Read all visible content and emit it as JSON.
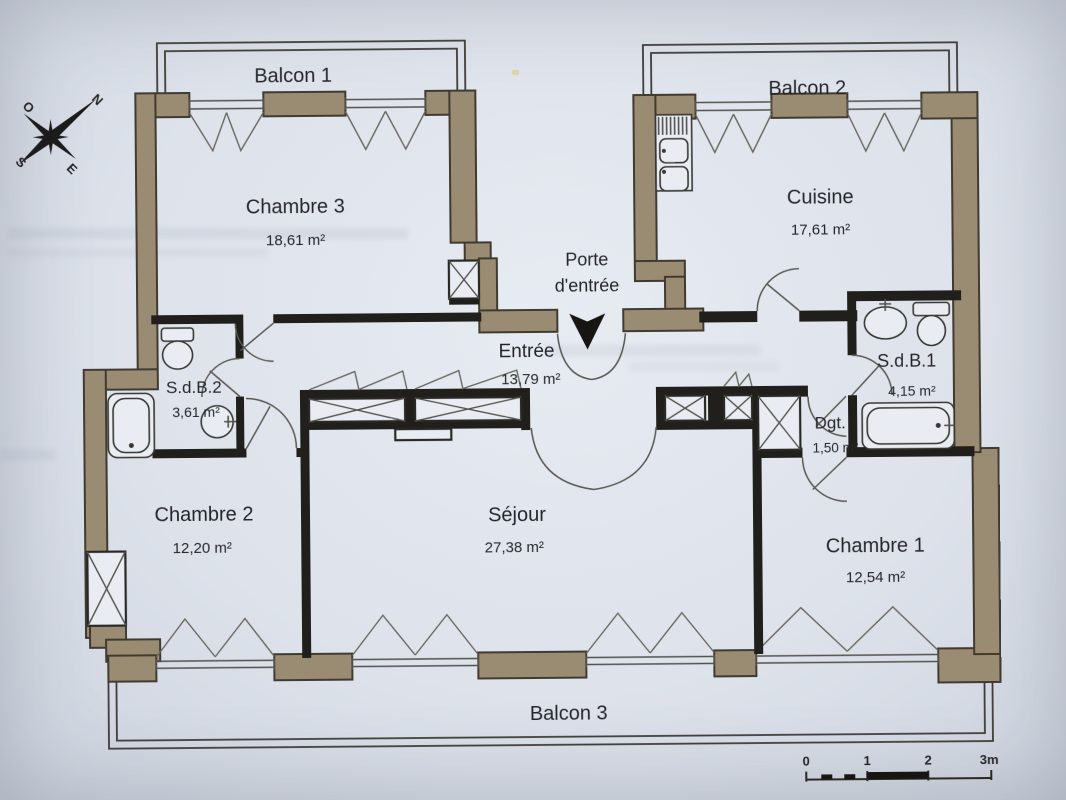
{
  "plan": {
    "balconies": {
      "b1": "Balcon 1",
      "b2": "Balcon 2",
      "b3": "Balcon 3"
    },
    "rooms": {
      "chambre3": {
        "name": "Chambre 3",
        "area": "18,61 m²"
      },
      "cuisine": {
        "name": "Cuisine",
        "area": "17,61 m²"
      },
      "entree": {
        "name": "Entrée",
        "area": "13,79 m²"
      },
      "sdb2": {
        "name": "S.d.B.2",
        "area": "3,61 m²"
      },
      "sdb1": {
        "name": "S.d.B.1",
        "area": "4,15 m²"
      },
      "chambre2": {
        "name": "Chambre 2",
        "area": "12,20 m²"
      },
      "sejour": {
        "name": "Séjour",
        "area": "27,38 m²"
      },
      "chambre1": {
        "name": "Chambre 1",
        "area": "12,54 m²"
      },
      "dgt": {
        "name": "Dgt.",
        "area": "1,50 m²"
      }
    },
    "entrance": {
      "line1": "Porte",
      "line2": "d'entrée"
    },
    "compass": {
      "n": "N",
      "o": "O",
      "s": "S",
      "e": "E"
    },
    "scale": {
      "t0": "0",
      "t1": "1",
      "t2": "2",
      "t3": "3m"
    },
    "colors": {
      "exterior_wall": "#9a8c72",
      "interior_wall": "#211f1b",
      "paper": "#dde2ea",
      "thin_line": "#4a4843",
      "text": "#26262a"
    }
  }
}
